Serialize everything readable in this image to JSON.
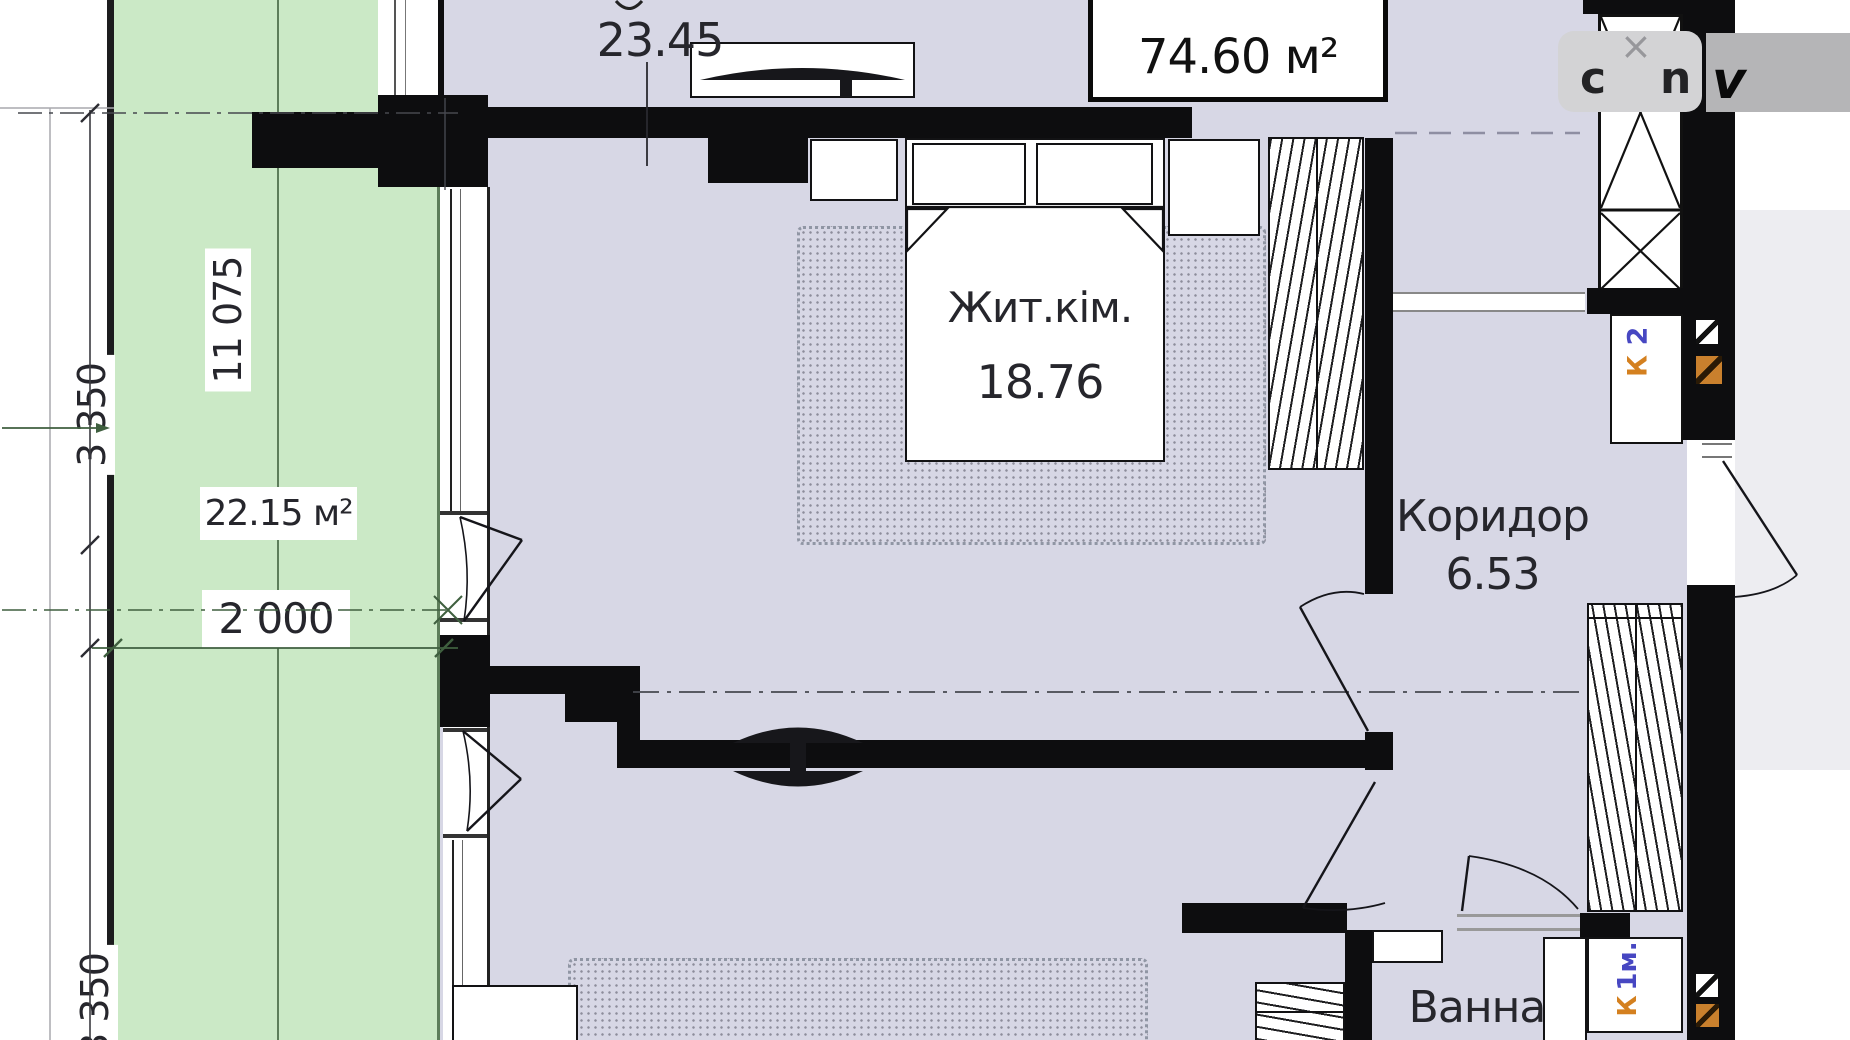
{
  "view": {
    "type": "apartment-floor-plan"
  },
  "overlay": {
    "close": "×",
    "fragment_left": "c",
    "fragment_right": "n",
    "fragment_logo": "v"
  },
  "plan": {
    "total_area": "74.60 м²",
    "rooms": [
      {
        "name": "",
        "area": "23.45"
      },
      {
        "name": "Жит.кім.",
        "area": "18.76"
      },
      {
        "name": "Коридор",
        "area": "6.53"
      },
      {
        "name": "Ванна",
        "area": ""
      }
    ],
    "balcony": {
      "area": "22.15 м²",
      "width": "2 000",
      "length": "11 075"
    },
    "dimensions": {
      "left_upper": "3 350",
      "left_lower": "3 350"
    },
    "ducts": [
      {
        "letter": "К",
        "index": "2"
      },
      {
        "letter": "К",
        "index": "1м."
      }
    ],
    "colors": {
      "floor": "#d7d7e5",
      "balcony": "#cbe9c6",
      "wall": "#0d0d0f",
      "duct_letter": "#d4801f",
      "duct_index": "#4747c2"
    }
  }
}
